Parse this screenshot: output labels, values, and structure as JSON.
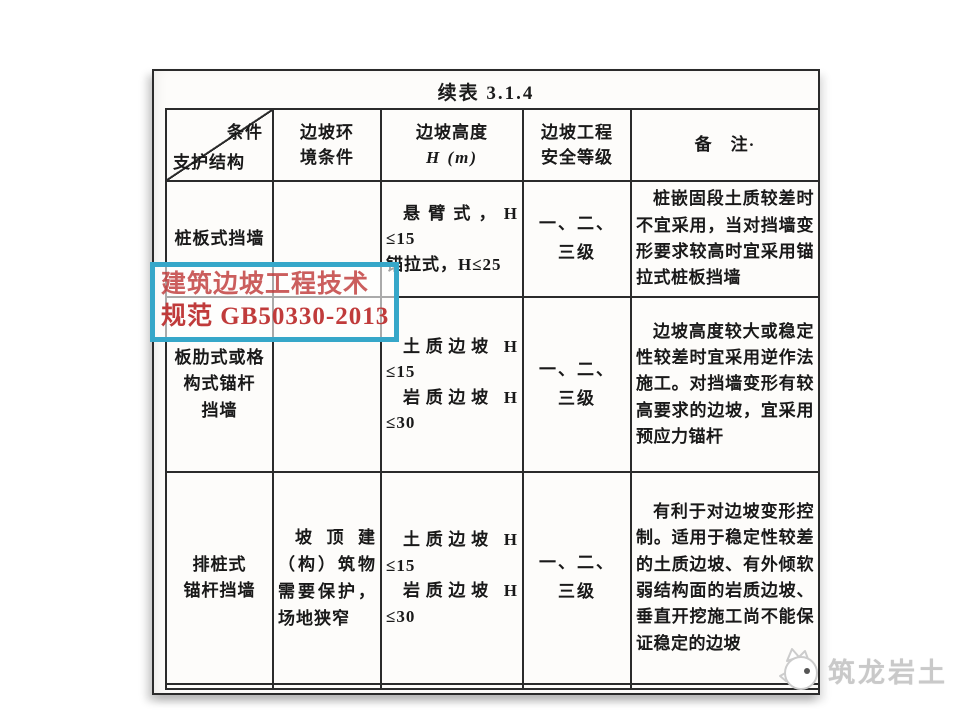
{
  "doc": {
    "title": "续表 3.1.4"
  },
  "table": {
    "header": {
      "corner_top": "条件",
      "corner_bottom": "支护结构",
      "env": "边坡环\n境条件",
      "height_line1": "边坡高度",
      "height_line2": "H (m)",
      "grade": "边坡工程\n安全等级",
      "remark": "备　注·"
    },
    "rows": [
      {
        "structure": "桩板式挡墙",
        "environment": "",
        "height_lines": [
          "悬臂式，H",
          "≤15",
          "锚拉式，H≤25"
        ],
        "grade": "一、二、\n三级",
        "remark": "桩嵌固段土质较差时不宜采用，当对挡墙变形要求较高时宜采用锚拉式桩板挡墙"
      },
      {
        "structure": "板肋式或格\n构式锚杆\n挡墙",
        "environment": "",
        "height_lines": [
          "土质边坡 H",
          "≤15",
          "岩质边坡 H",
          "≤30"
        ],
        "grade": "一、二、\n三级",
        "remark": "边坡高度较大或稳定性较差时宜采用逆作法施工。对挡墙变形有较高要求的边坡，宜采用预应力锚杆"
      },
      {
        "structure": "排桩式\n锚杆挡墙",
        "environment": "坡顶建（构）筑物需要保护，场地狭窄",
        "height_lines": [
          "土质边坡 H",
          "≤15",
          "岩质边坡 H",
          "≤30"
        ],
        "grade": "一、二、\n三级",
        "remark": "有利于对边坡变形控制。适用于稳定性较差的土质边坡、有外倾软弱结构面的岩质边坡、垂直开挖施工尚不能保证稳定的边坡"
      }
    ]
  },
  "stamp": {
    "line1": "建筑边坡工程技术",
    "line2": "规范 GB50330-2013",
    "border_color": "#36a7c9",
    "text_color": "#c03b3b"
  },
  "watermark": {
    "brand": "筑龙岩土",
    "color": "#c9c9c9"
  }
}
